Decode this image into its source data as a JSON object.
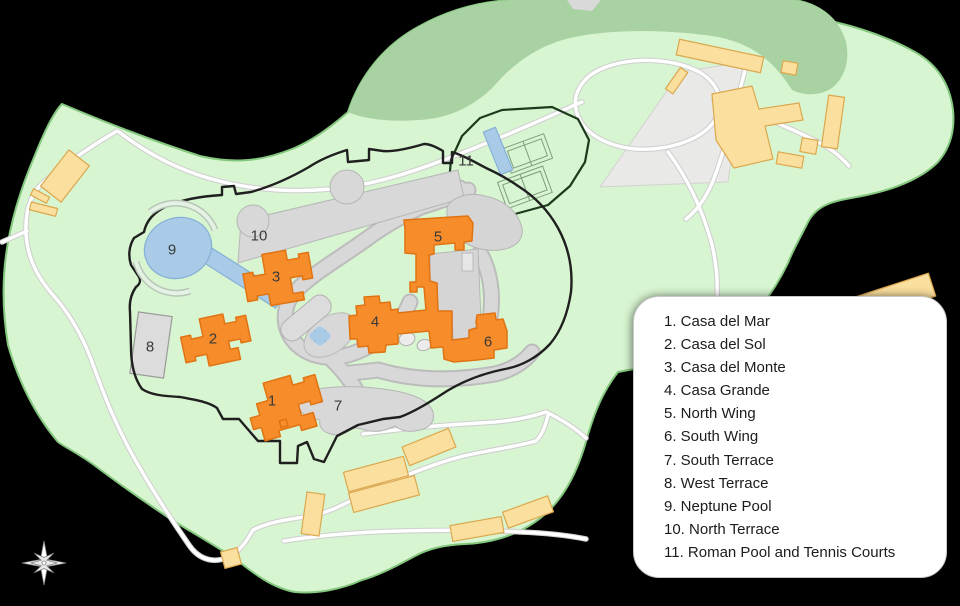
{
  "map": {
    "name": "Hearst Castle grounds site map",
    "labels": [
      {
        "id": "label-1",
        "text": "1",
        "x": 272,
        "y": 401
      },
      {
        "id": "label-2",
        "text": "2",
        "x": 213,
        "y": 339
      },
      {
        "id": "label-3",
        "text": "3",
        "x": 276,
        "y": 277
      },
      {
        "id": "label-4",
        "text": "4",
        "x": 375,
        "y": 322
      },
      {
        "id": "label-5",
        "text": "5",
        "x": 438,
        "y": 237
      },
      {
        "id": "label-6",
        "text": "6",
        "x": 488,
        "y": 342
      },
      {
        "id": "label-7",
        "text": "7",
        "x": 338,
        "y": 406
      },
      {
        "id": "label-8",
        "text": "8",
        "x": 150,
        "y": 347
      },
      {
        "id": "label-9",
        "text": "9",
        "x": 172,
        "y": 250
      },
      {
        "id": "label-10",
        "text": "10",
        "x": 259,
        "y": 236
      },
      {
        "id": "label-11",
        "text": "11",
        "x": 466,
        "y": 161
      }
    ],
    "palette": {
      "grounds_green": "#d8f5d1",
      "forest_green": "#a9d2a2",
      "grounds_edge": "#84c77e",
      "building_orange": "#f78c2a",
      "building_orange_edge": "#e07312",
      "outbuilding_yellow": "#fbdf9f",
      "outbuilding_yellow_edge": "#dca84e",
      "terrace_gray": "#d8d8d8",
      "terrace_gray_edge": "#b5b5b5",
      "pool_blue": "#a9cbe8",
      "pool_blue_edge": "#85b0d6",
      "boundary_black": "#1f1f1f",
      "road_white": "#ffffff",
      "road_casing": "#cfcfcf"
    }
  },
  "legend": {
    "items": [
      "1. Casa del Mar",
      "2. Casa del Sol",
      "3. Casa del Monte",
      "4. Casa Grande",
      "5. North Wing",
      "6. South Wing",
      "7. South Terrace",
      "8. West Terrace",
      "9. Neptune Pool",
      "10. North Terrace",
      "11. Roman Pool and Tennis Courts"
    ]
  },
  "compass": {
    "label": "compass-rose"
  }
}
